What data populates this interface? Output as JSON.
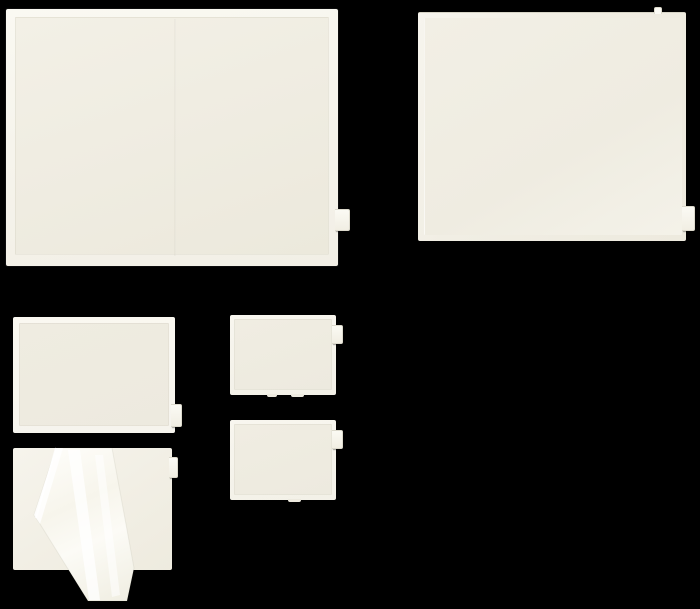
{
  "scene": {
    "type": "product-photo",
    "alt": "Six blank cream-colored self-adhesive packing list envelopes of assorted sizes arranged on a black background; one envelope has its clear protective release liner peeled back and draped over the front",
    "background_color": "#000000"
  },
  "colors": {
    "background": "#000000",
    "envelope_face": "#efece1",
    "envelope_border": "#f9f7f0",
    "edge_shadow": "#d7d4c6",
    "pull_tab": "#f8f6f0",
    "liner_film_highlight": "#ffffff"
  },
  "items": [
    {
      "id": "envelope-xl-top-left",
      "desc": "Extra-large blank adhesive envelope, landscape, pull tab protruding from right edge near the bottom corner"
    },
    {
      "id": "envelope-lg-top-right",
      "desc": "Large blank adhesive envelope, landscape, pull tab at lower right edge and a small liner notch at the top right"
    },
    {
      "id": "envelope-md-mid-left",
      "desc": "Medium blank adhesive envelope with white border frame and pull tab on the lower right edge"
    },
    {
      "id": "envelope-sm-upper",
      "desc": "Small blank adhesive envelope with pull tab on the upper right edge and liner notches at the bottom"
    },
    {
      "id": "envelope-sm-lower",
      "desc": "Small blank adhesive envelope with pull tab on the upper right edge and liner notch at the bottom"
    },
    {
      "id": "envelope-peeled-liner",
      "desc": "Adhesive envelope with its transparent release liner peeled back diagonally, the glossy film hanging below the pouch"
    }
  ]
}
